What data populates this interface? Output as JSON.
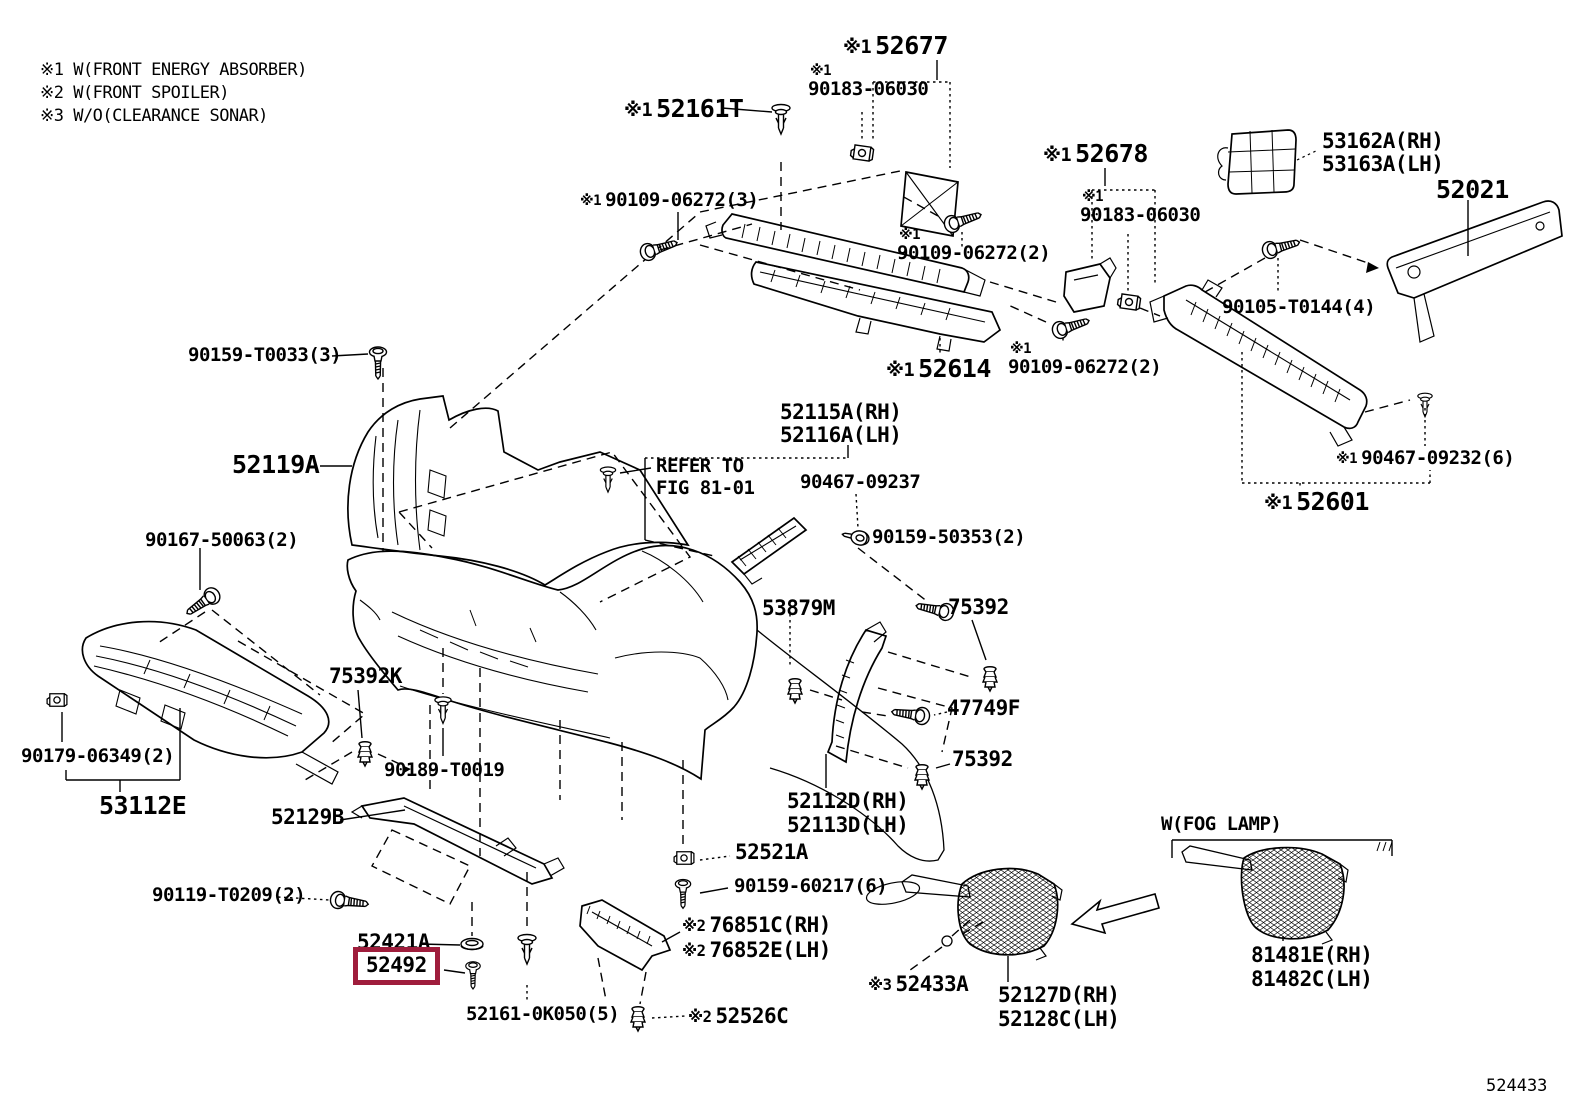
{
  "legend": {
    "items": [
      "※1 W(FRONT ENERGY ABSORBER)",
      "※2 W(FRONT SPOILER)",
      "※3 W/O(CLEARANCE SONAR)"
    ]
  },
  "figure_number": "524433",
  "highlight": {
    "part": "52492",
    "box_color": "#9f1d3c"
  },
  "notes": {
    "fog_lamp_section": "W(FOG LAMP)",
    "cross_reference": "REFER TO FIG 81-01"
  },
  "labels": [
    {
      "prefix": "※1",
      "text": "52677"
    },
    {
      "prefix": "※1",
      "text": "52161T"
    },
    {
      "prefix": "※1",
      "text": "90183-06030"
    },
    {
      "prefix": "※1",
      "text": "52678"
    },
    {
      "prefix": "※1",
      "text": "90183-06030"
    },
    {
      "text": "53162A(RH)"
    },
    {
      "text": "53163A(LH)"
    },
    {
      "text": "52021"
    },
    {
      "prefix": "※1",
      "text": "90109-06272(3)"
    },
    {
      "prefix": "※1",
      "text": "90109-06272(2)"
    },
    {
      "text": "90105-T0144(4)"
    },
    {
      "prefix": "※1",
      "text": "52614"
    },
    {
      "prefix": "※1",
      "text": "90109-06272(2)"
    },
    {
      "prefix": "※1",
      "text": "90467-09232(6)"
    },
    {
      "prefix": "※1",
      "text": "52601"
    },
    {
      "text": "52115A(RH)"
    },
    {
      "text": "52116A(LH)"
    },
    {
      "text": "REFER TO"
    },
    {
      "text": "FIG 81-01"
    },
    {
      "text": "90467-09237"
    },
    {
      "text": "90159-50353(2)"
    },
    {
      "text": "52119A"
    },
    {
      "text": "90159-T0033(3)"
    },
    {
      "text": "90167-50063(2)"
    },
    {
      "text": "53879M"
    },
    {
      "text": "75392"
    },
    {
      "text": "75392K"
    },
    {
      "text": "47749F"
    },
    {
      "text": "75392"
    },
    {
      "text": "90179-06349(2)"
    },
    {
      "text": "53112E"
    },
    {
      "text": "90189-T0019"
    },
    {
      "text": "52129B"
    },
    {
      "text": "52112D(RH)"
    },
    {
      "text": "52113D(LH)"
    },
    {
      "text": "52521A"
    },
    {
      "text": "90159-60217(6)"
    },
    {
      "text": "90119-T0209(2)"
    },
    {
      "text": "52421A"
    },
    {
      "text": "52492"
    },
    {
      "prefix": "※2",
      "text": "76851C(RH)"
    },
    {
      "prefix": "※2",
      "text": "76852E(LH)"
    },
    {
      "text": "52161-0K050(5)"
    },
    {
      "prefix": "※2",
      "text": "52526C"
    },
    {
      "prefix": "※3",
      "text": "52433A"
    },
    {
      "text": "52127D(RH)"
    },
    {
      "text": "52128C(LH)"
    },
    {
      "text": "W(FOG LAMP)"
    },
    {
      "text": "81481E(RH)"
    },
    {
      "text": "81482C(LH)"
    }
  ]
}
